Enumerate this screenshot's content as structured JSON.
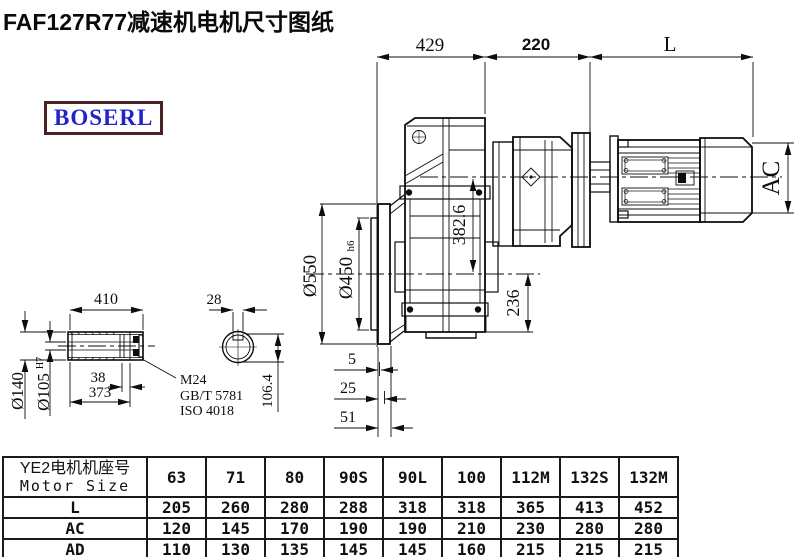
{
  "title": "FAF127R77减速机电机尺寸图纸",
  "brand": {
    "logo_text": "BOSERL"
  },
  "drawing": {
    "top_dims": {
      "d429": "429",
      "d220": "220",
      "dL": "L"
    },
    "motor_dims": {
      "ac": "AC"
    },
    "flange_dims": {
      "d550": "Ø550",
      "d450": "Ø450",
      "d450_tol": "h6",
      "d382": "382.6",
      "d236": "236"
    },
    "foot_dims": {
      "d5": "5",
      "d25": "25",
      "d51": "51"
    },
    "shaft_dims": {
      "d410": "410",
      "d140": "Ø140",
      "d105": "Ø105",
      "d105_tol": "H7",
      "d38": "38",
      "d373": "373",
      "d28": "28",
      "d1064": "106.4"
    },
    "bolt_note": {
      "line1": "M24",
      "line2": "GB/T 5781",
      "line3": "ISO 4018"
    }
  },
  "table": {
    "header": {
      "cn": "YE2电机机座号",
      "en": "Motor Size"
    },
    "columns": [
      "63",
      "71",
      "80",
      "90S",
      "90L",
      "100",
      "112M",
      "132S",
      "132M"
    ],
    "rows": [
      {
        "label": "L",
        "values": [
          "205",
          "260",
          "280",
          "288",
          "318",
          "318",
          "365",
          "413",
          "452"
        ]
      },
      {
        "label": "AC",
        "values": [
          "120",
          "145",
          "170",
          "190",
          "190",
          "210",
          "230",
          "280",
          "280"
        ]
      },
      {
        "label": "AD",
        "values": [
          "110",
          "130",
          "135",
          "145",
          "145",
          "160",
          "215",
          "215",
          "215"
        ]
      }
    ]
  },
  "colors": {
    "ink": "#111111",
    "logo_text": "#2323c8",
    "logo_border": "#4a2222",
    "background": "#ffffff"
  }
}
